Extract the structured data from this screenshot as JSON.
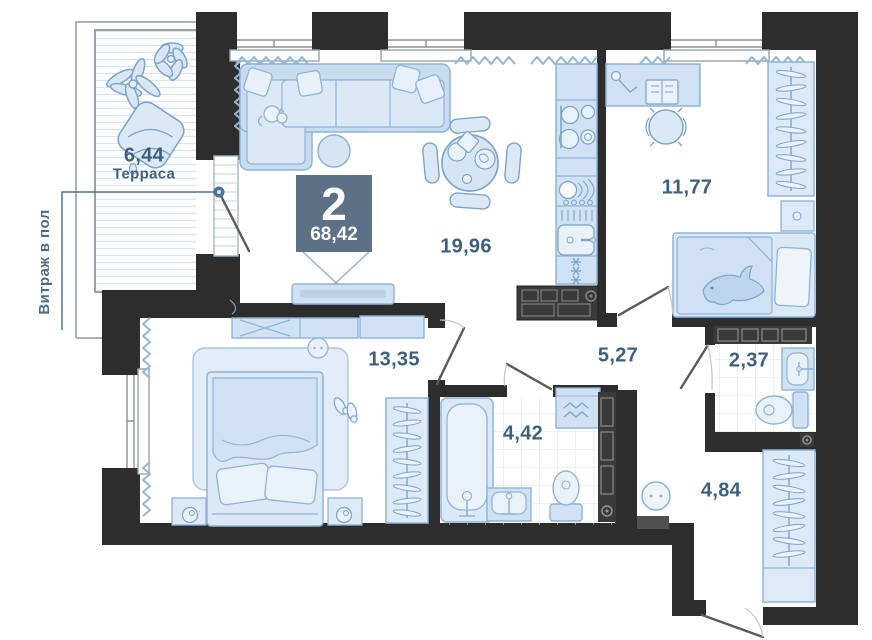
{
  "plan_title": "2-room apartment floor plan",
  "badge": {
    "rooms_count": "2",
    "total_area": "68,42"
  },
  "callout": {
    "glazing_label": "Витраж в пол"
  },
  "rooms": {
    "terrace": {
      "area": "6,44",
      "name": "Терраса"
    },
    "living_kitchen": {
      "area": "19,96"
    },
    "bedroom_second": {
      "area": "11,77"
    },
    "bedroom_master": {
      "area": "13,35"
    },
    "hallway": {
      "area": "5,27"
    },
    "wc": {
      "area": "2,37"
    },
    "bathroom": {
      "area": "4,42"
    },
    "entry": {
      "area": "4,84"
    }
  },
  "colors": {
    "wall": "#2d2d2d",
    "furniture_fill": "#d3e2f2",
    "furniture_fill_light": "#e8f0f9",
    "furniture_stroke": "#7ca4cd",
    "radiator": "#93b6da",
    "label_text": "#3e6080",
    "badge_bg": "#5c7086",
    "badge_text": "#ffffff",
    "dark_cabinet": "#3a3a3a"
  }
}
